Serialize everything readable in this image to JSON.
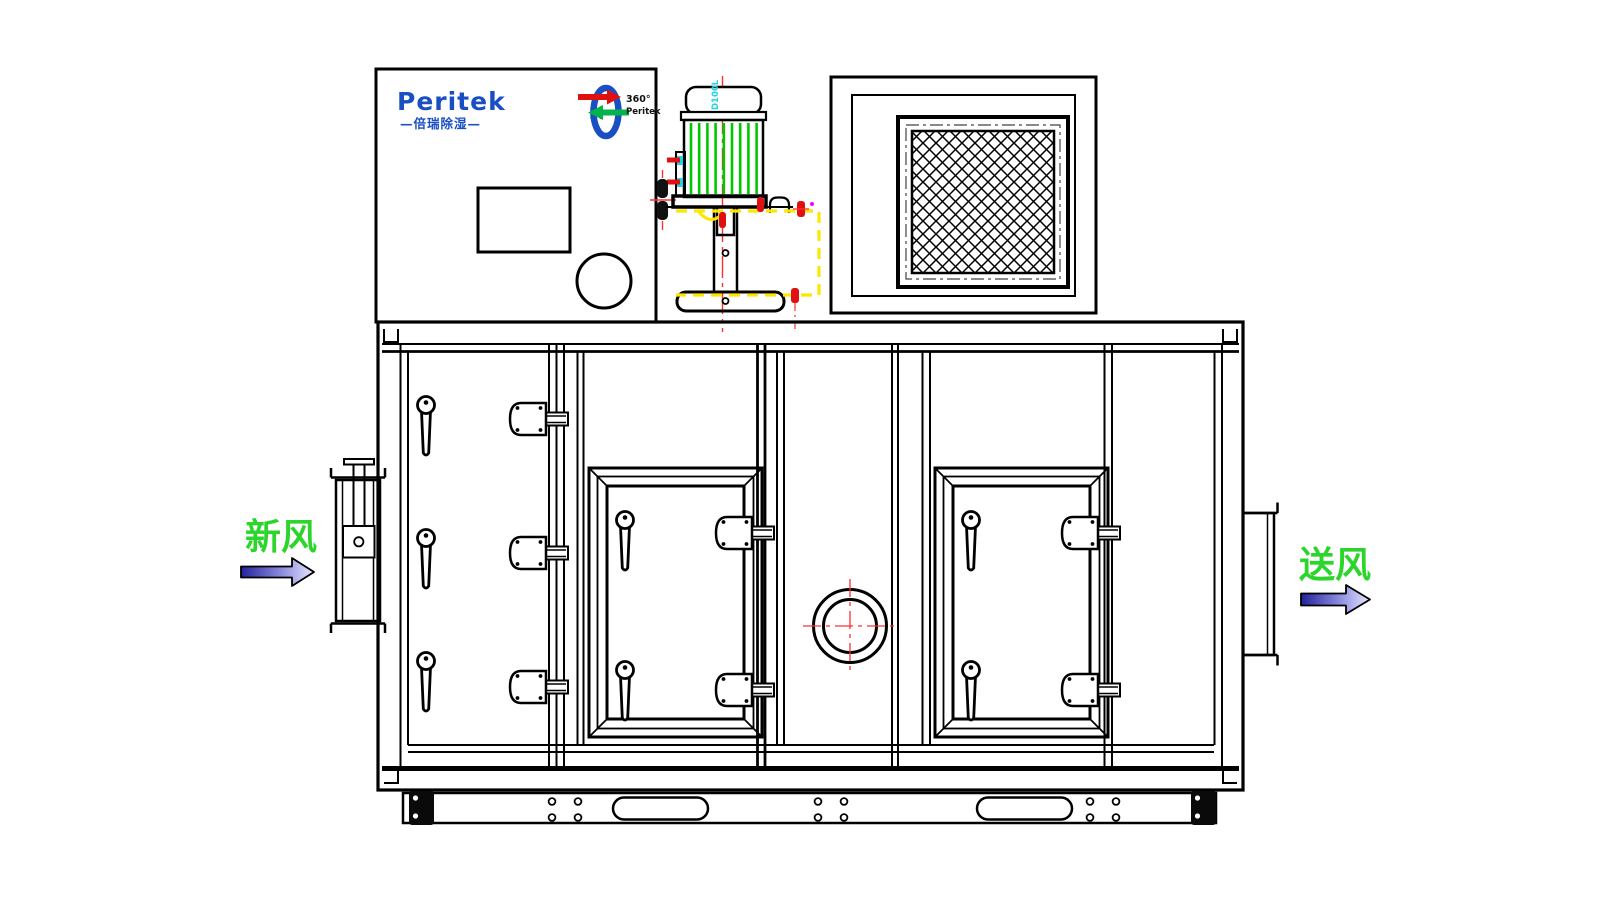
{
  "brand": {
    "name": "Peritek",
    "subtext": "—倍瑞除湿—",
    "monogram": "M"
  },
  "badge": {
    "degrees": "360°",
    "name": "Peritek"
  },
  "motor": {
    "frame_label": "D100L"
  },
  "flow": {
    "inlet": "新风",
    "outlet": "送风"
  },
  "colors": {
    "line": "#000000",
    "brand_blue": "#1a4fc4",
    "fin_green": "#00c800",
    "centerline_red": "#ff3030",
    "bolt_red": "#e01010",
    "dash_yellow": "#ffe600",
    "accent_cyan": "#22d4e4",
    "arrow_green": "#00b34a",
    "label_green": "#2bd52b",
    "arrow_fill_dark": "#23239b",
    "arrow_fill_light": "#e6e6ff",
    "magenta_marker": "#ff00ff"
  }
}
